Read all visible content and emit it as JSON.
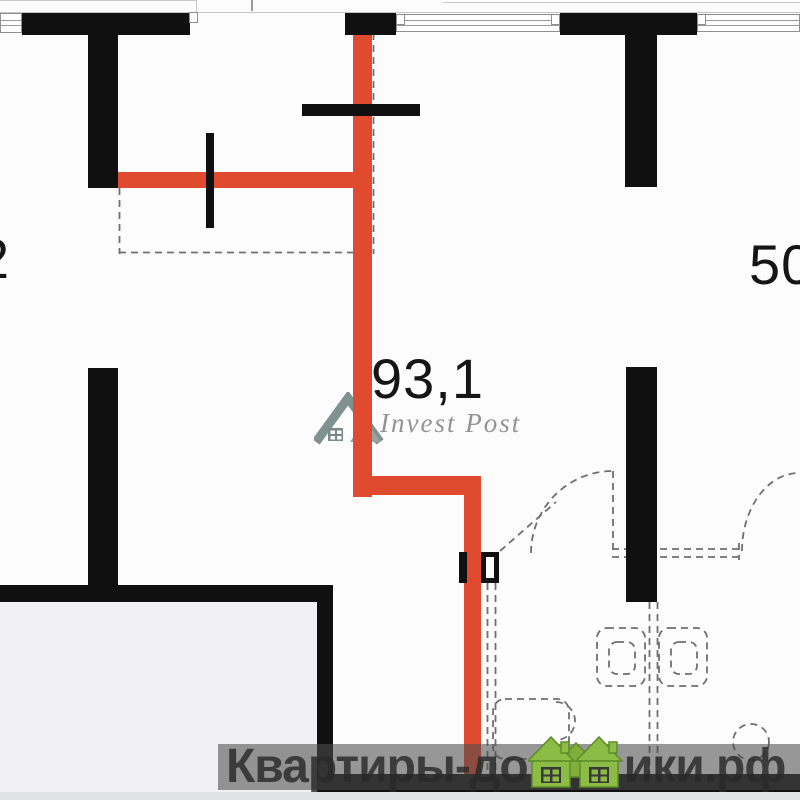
{
  "title": "apartment-floor-plan",
  "labels": {
    "area_main": "93,1",
    "area_left": "2",
    "area_right": "50"
  },
  "watermark_invest": {
    "text": "Invest Post",
    "logo": "invest-post-roof-logo"
  },
  "watermark_site": {
    "left": "Квартиры-до",
    "right": "ики.рф",
    "logo": "green-houses-logo"
  },
  "colors": {
    "wall_black": "#101010",
    "route_red": "#e04a2e",
    "dashed_gray": "#6f6f6f",
    "room_fill": "#f1f1f4",
    "band_overlay": "rgba(77,77,77,0.58)",
    "site_text": "#2f2f2f",
    "house_green": "#8cbc45",
    "invest_text_gray": "#8e8e8e"
  }
}
